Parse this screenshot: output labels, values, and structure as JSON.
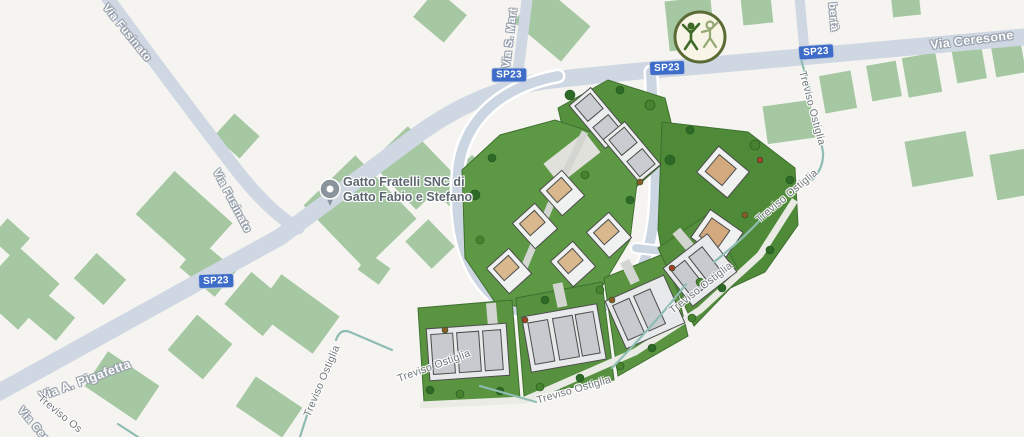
{
  "map": {
    "badge_sp23": "SP23",
    "roads": {
      "via_fusinato": "Via Fusinato",
      "via_ceresone": "Via Ceresone",
      "via_pigafetta": "Via A. Pigafetta",
      "via_s_martino_partial": "Via S. Mart",
      "via_liberta_partial": "bertà",
      "via_cer_partial": "Via Cer",
      "treviso_ostiglia": "Treviso Ostiglia",
      "treviso_ostiglia_partial": "Treviso Os"
    },
    "poi": {
      "gatto_line1": "Gatto Fratelli SNC di",
      "gatto_line2": "Gatto Fabio e Stefano"
    },
    "colors": {
      "background": "#f5f4f1",
      "road": "#cfd7e3",
      "building_green": "#a5c8a2",
      "badge_blue": "#3d6cc9",
      "lawn_green": "#5a9440",
      "path_teal": "#8fbcb2",
      "label_gray": "#6f757a"
    }
  }
}
